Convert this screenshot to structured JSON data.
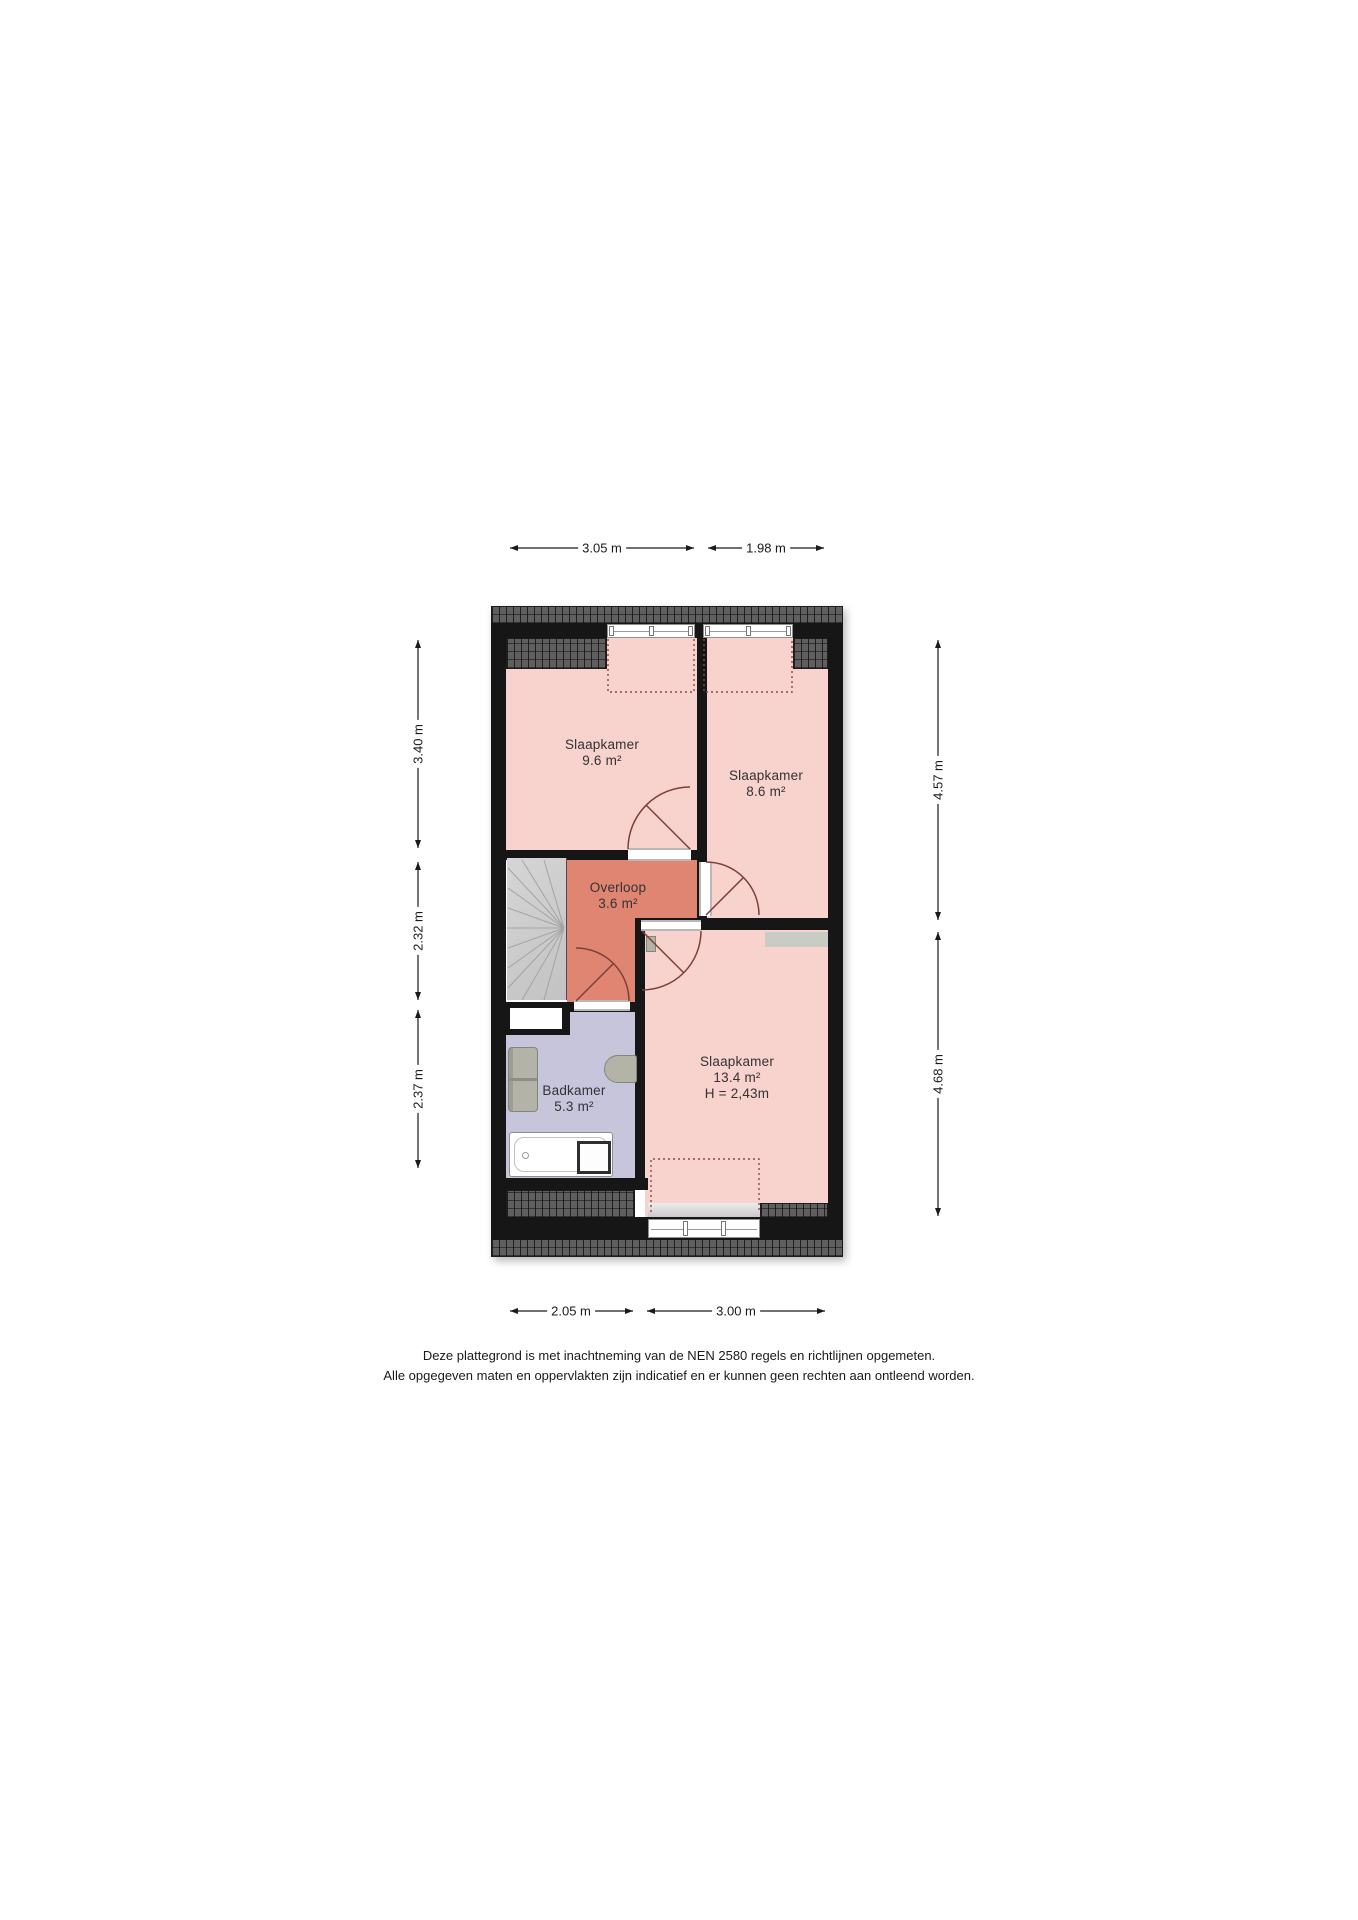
{
  "plan": {
    "rooms": {
      "slaapkamer1": {
        "name": "Slaapkamer",
        "area": "9.6 m²"
      },
      "slaapkamer2": {
        "name": "Slaapkamer",
        "area": "8.6 m²"
      },
      "overloop": {
        "name": "Overloop",
        "area": "3.6 m²"
      },
      "badkamer": {
        "name": "Badkamer",
        "area": "5.3 m²"
      },
      "slaapkamer3": {
        "name": "Slaapkamer",
        "area": "13.4 m²",
        "height": "H = 2,43m"
      }
    },
    "dimensions": {
      "top": [
        "3.05 m",
        "1.98 m"
      ],
      "bottom": [
        "2.05 m",
        "3.00 m"
      ],
      "left": [
        "3.40 m",
        "2.32 m",
        "2.37 m"
      ],
      "right": [
        "4.57 m",
        "4.68 m"
      ]
    },
    "colors": {
      "room_pink": "#f8d2cc",
      "landing_salmon": "#e08572",
      "bathroom_lavender": "#c6c5dc",
      "wall_black": "#161616",
      "roof_tile_gray": "#5f5f5f",
      "door_arc_maroon": "#7a4038"
    }
  },
  "footer": {
    "line1": "Deze plattegrond is met inachtneming van de NEN 2580 regels en richtlijnen opgemeten.",
    "line2": "Alle opgegeven maten en oppervlakten zijn indicatief en er kunnen geen rechten aan ontleend worden."
  }
}
